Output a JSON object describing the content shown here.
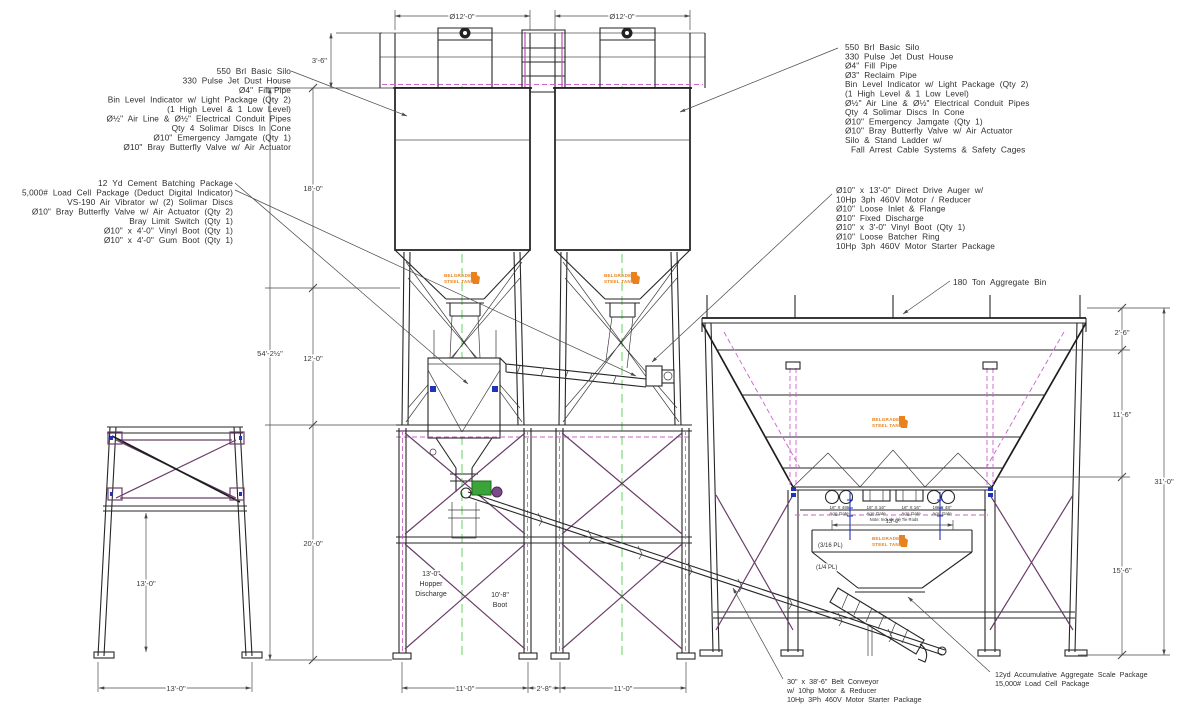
{
  "title": "Concrete Batch Plant Elevation Drawing",
  "notes_top_left": {
    "lines": [
      "550 Brl Basic Silo",
      "330 Pulse Jet Dust House",
      "Ø4\" Fill Pipe",
      "Bin Level Indicator w/ Light Package (Qty 2)",
      "(1 High Level & 1 Low Level)",
      "Ø½\" Air Line & Ø½\" Electrical Conduit Pipes",
      "Qty 4 Solimar Discs In Cone",
      "Ø10\" Emergency Jamgate (Qty 1)",
      "Ø10\" Bray Butterfly Valve w/ Air Actuator"
    ]
  },
  "notes_mid_left": {
    "lines": [
      "12 Yd Cement Batching Package",
      "5,000# Load Cell Package (Deduct Digital Indicator)",
      "VS-190 Air Vibrator w/ (2) Solimar Discs",
      "Ø10\" Bray Butterfly Valve w/ Air Actuator (Qty 2)",
      "Bray Limit Switch (Qty 1)",
      "Ø10\" x 4'-0\" Vinyl Boot (Qty 1)",
      "Ø10\" x 4'-0\" Gum Boot (Qty 1)"
    ]
  },
  "notes_top_right": {
    "lines": [
      "550 Brl Basic Silo",
      "330 Pulse Jet Dust House",
      "Ø4\" Fill Pipe",
      "Ø3\" Reclaim Pipe",
      "Bin Level Indicator w/ Light Package (Qty 2)",
      "(1 High Level & 1 Low Level)",
      "Ø½\" Air Line & Ø½\" Electrical Conduit Pipes",
      "Qty 4 Solimar Discs In Cone",
      "Ø10\" Emergency Jamgate (Qty 1)",
      "Ø10\" Bray Butterfly Valve w/ Air Actuator",
      "Silo & Stand Ladder w/",
      "Fall Arrest Cable Systems & Safety Cages"
    ]
  },
  "notes_mid_right": {
    "lines": [
      "Ø10\" x 13'-0\" Direct Drive Auger w/",
      "10Hp 3ph 460V Motor / Reducer",
      "Ø10\" Loose Inlet & Flange",
      "Ø10\" Fixed Discharge",
      "Ø10\" x 3'-0\" Vinyl Boot (Qty 1)",
      "Ø10\" Loose Batcher Ring",
      "10Hp 3ph 460V Motor Starter Package"
    ]
  },
  "notes_conveyor": {
    "lines": [
      "30\" x 38'-6\" Belt Conveyor",
      "w/ 10hp Motor & Reducer",
      "10Hp 3Ph 460V Motor Starter Package"
    ]
  },
  "notes_scale": {
    "lines": [
      "12yd Accumulative Aggregate Scale Package",
      "15,000# Load Cell Package"
    ]
  },
  "label_aggregate_bin": "180 Ton Aggregate Bin",
  "tower": {
    "hopper_discharge": [
      "13'-0\"",
      "Hopper",
      "Discharge"
    ],
    "boot": [
      "10'-8\"",
      "Boot"
    ]
  },
  "plates": {
    "upper": "(3/16 PL)",
    "lower": "(1/4 PL)"
  },
  "gate_labels": {
    "outer_size": "16\" X 48\"",
    "inner_size": "16\" X 16\"",
    "gate": "Agg Gate",
    "note": "Note: Include (1) Tie Rods"
  },
  "logo": {
    "line1": "BELGRADE",
    "line2": "STEEL TANK"
  },
  "dims": {
    "silo_dia_left": "Ø12'-0\"",
    "silo_dia_right": "Ø12'-0\"",
    "rail_height": "3'-6\"",
    "silo_body": "18'-0\"",
    "cone_section": "12'-0\"",
    "tower_height": "20'-0\"",
    "overall_height": "54'-2½\"",
    "stand_height": "13'-0\"",
    "stand_width": "13'-0\"",
    "bay_left": "11'-0\"",
    "bay_center": "2'-8\"",
    "bay_right": "11'-0\"",
    "bin_top": "2'-6\"",
    "bin_hopper": "11'-6\"",
    "bin_legs": "15'-6\"",
    "bin_overall": "31'-0\"",
    "scale_hopper_width": "13'-0\""
  }
}
